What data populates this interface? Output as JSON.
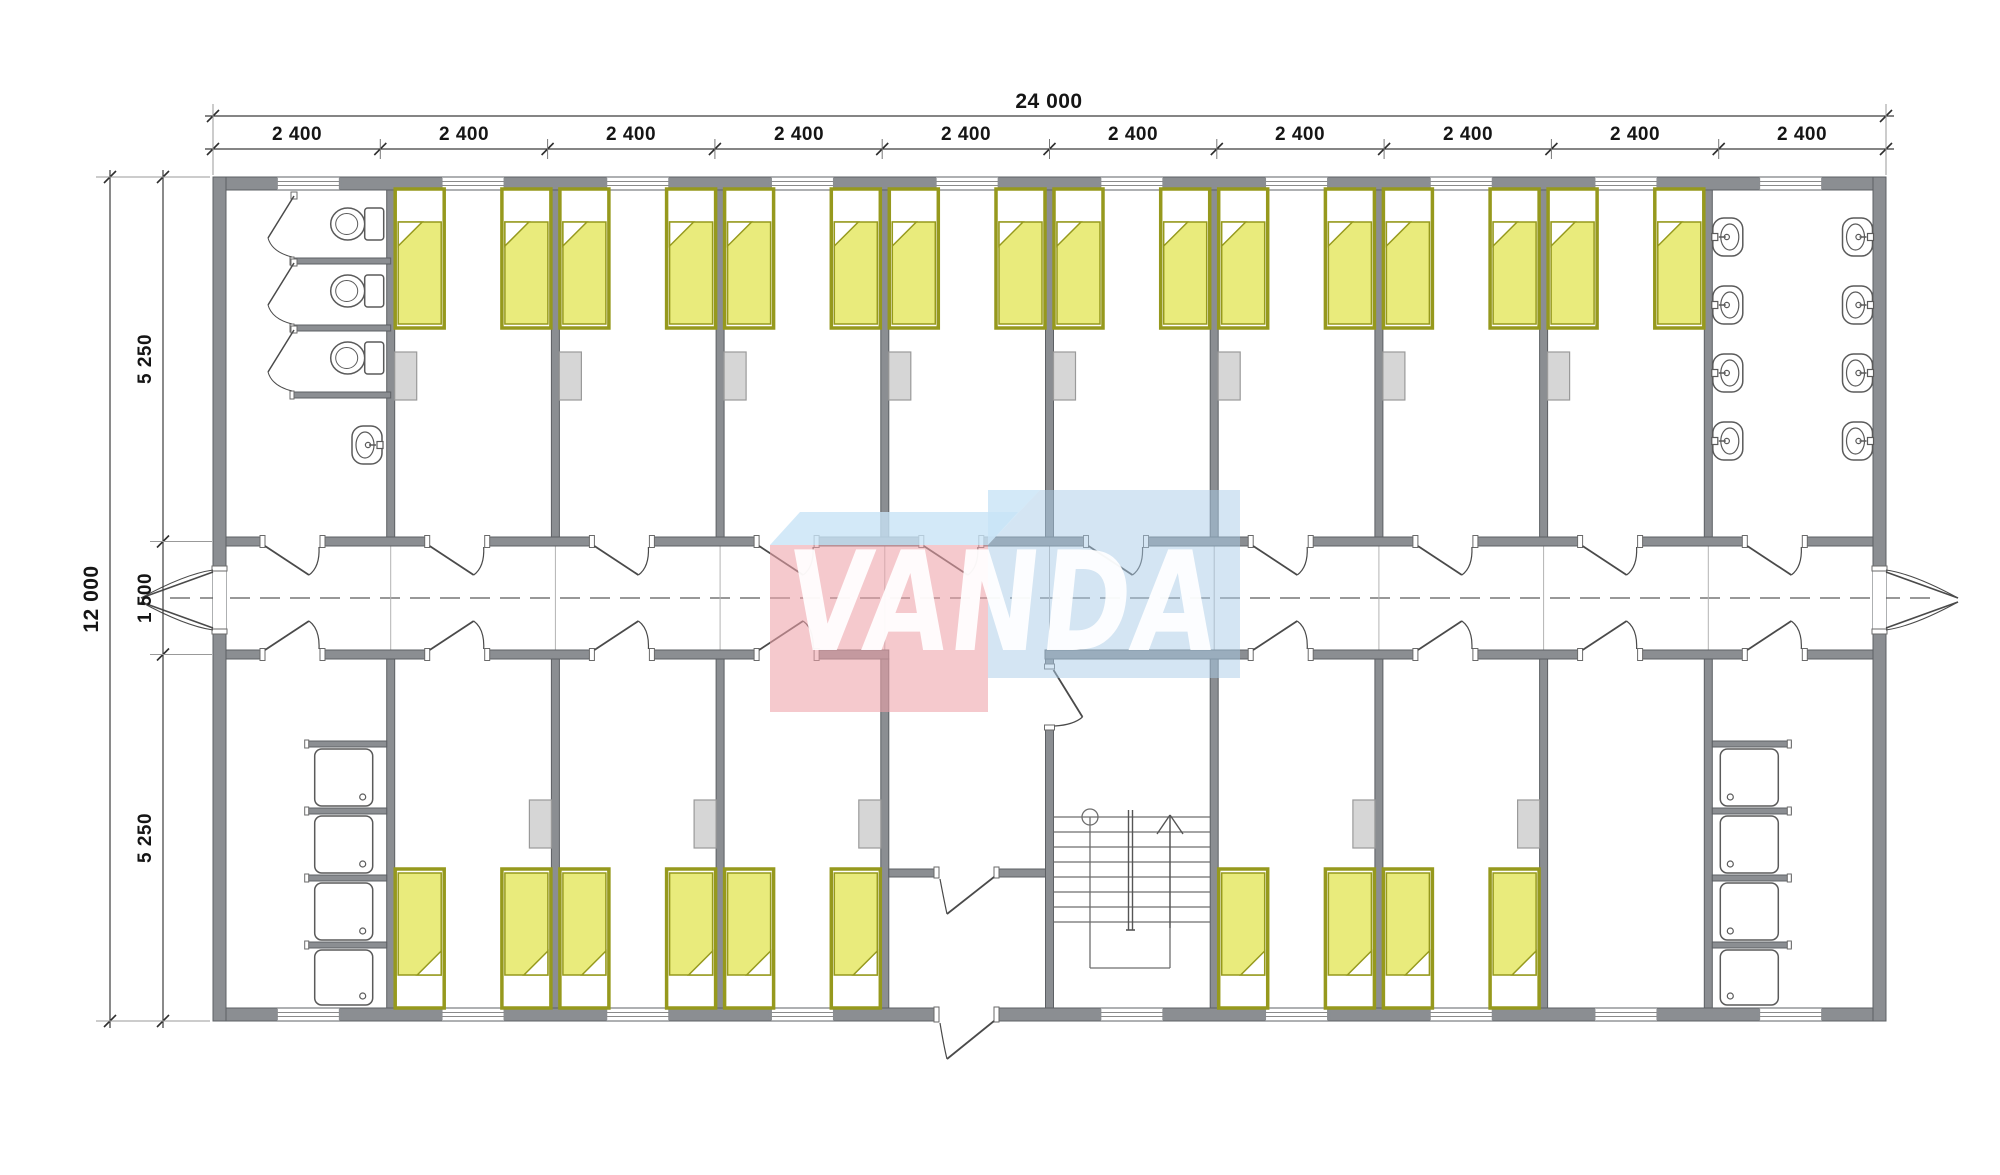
{
  "logo": {
    "text": "VANDA",
    "pink": "#eda2a9",
    "blue": "#a9cbe8",
    "light_blue": "#c8e4f6",
    "letter_color": "#ffffff"
  },
  "dimensions": {
    "top_total": "24 000",
    "top_modules": [
      "2 400",
      "2 400",
      "2 400",
      "2 400",
      "2 400",
      "2 400",
      "2 400",
      "2 400",
      "2 400",
      "2 400"
    ],
    "left_total": "12 000",
    "left_segments": [
      "5 250",
      "1 500",
      "5 250"
    ]
  },
  "plan": {
    "colors": {
      "wall": "#8b8e92",
      "wall_stroke": "#5d6064",
      "bed_fill": "#e9eb7c",
      "bed_frame": "#96991d",
      "fixture_stroke": "#5a5a5a",
      "furniture_fill": "#d6d6d6",
      "furniture_stroke": "#9a9a9a",
      "dim_color": "#3c3c3c",
      "door_color": "#4a4a4a",
      "stair_color": "#6e6e6e"
    },
    "fixtures": {
      "beds": 26,
      "toilets": 3,
      "wash_basins": 9,
      "showers": 8,
      "staircases": 1
    }
  }
}
